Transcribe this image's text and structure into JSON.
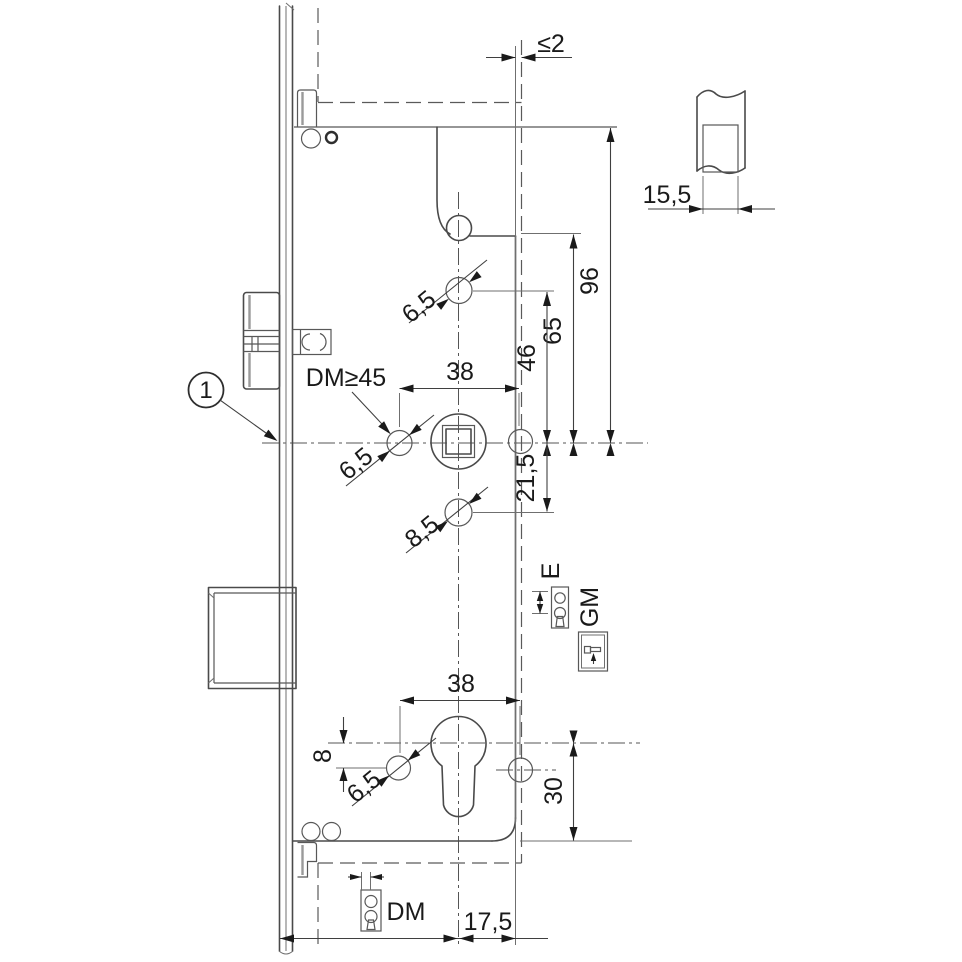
{
  "drawing": {
    "balloon": "1",
    "dims": {
      "gap": "≤2",
      "detail_width": "15,5",
      "v96": "96",
      "v65": "65",
      "v46": "46",
      "v21_5": "21,5",
      "v30": "30",
      "v8": "8",
      "w38_top": "38",
      "w38_bottom": "38",
      "w17_5": "17,5",
      "hole_top": "6,5",
      "hole_mid": "6,5",
      "hole_85": "8,5",
      "hole_bottom": "6,5"
    },
    "labels": {
      "dm_min": "DM≥45",
      "dm": "DM",
      "e": "E",
      "gm": "GM"
    }
  }
}
